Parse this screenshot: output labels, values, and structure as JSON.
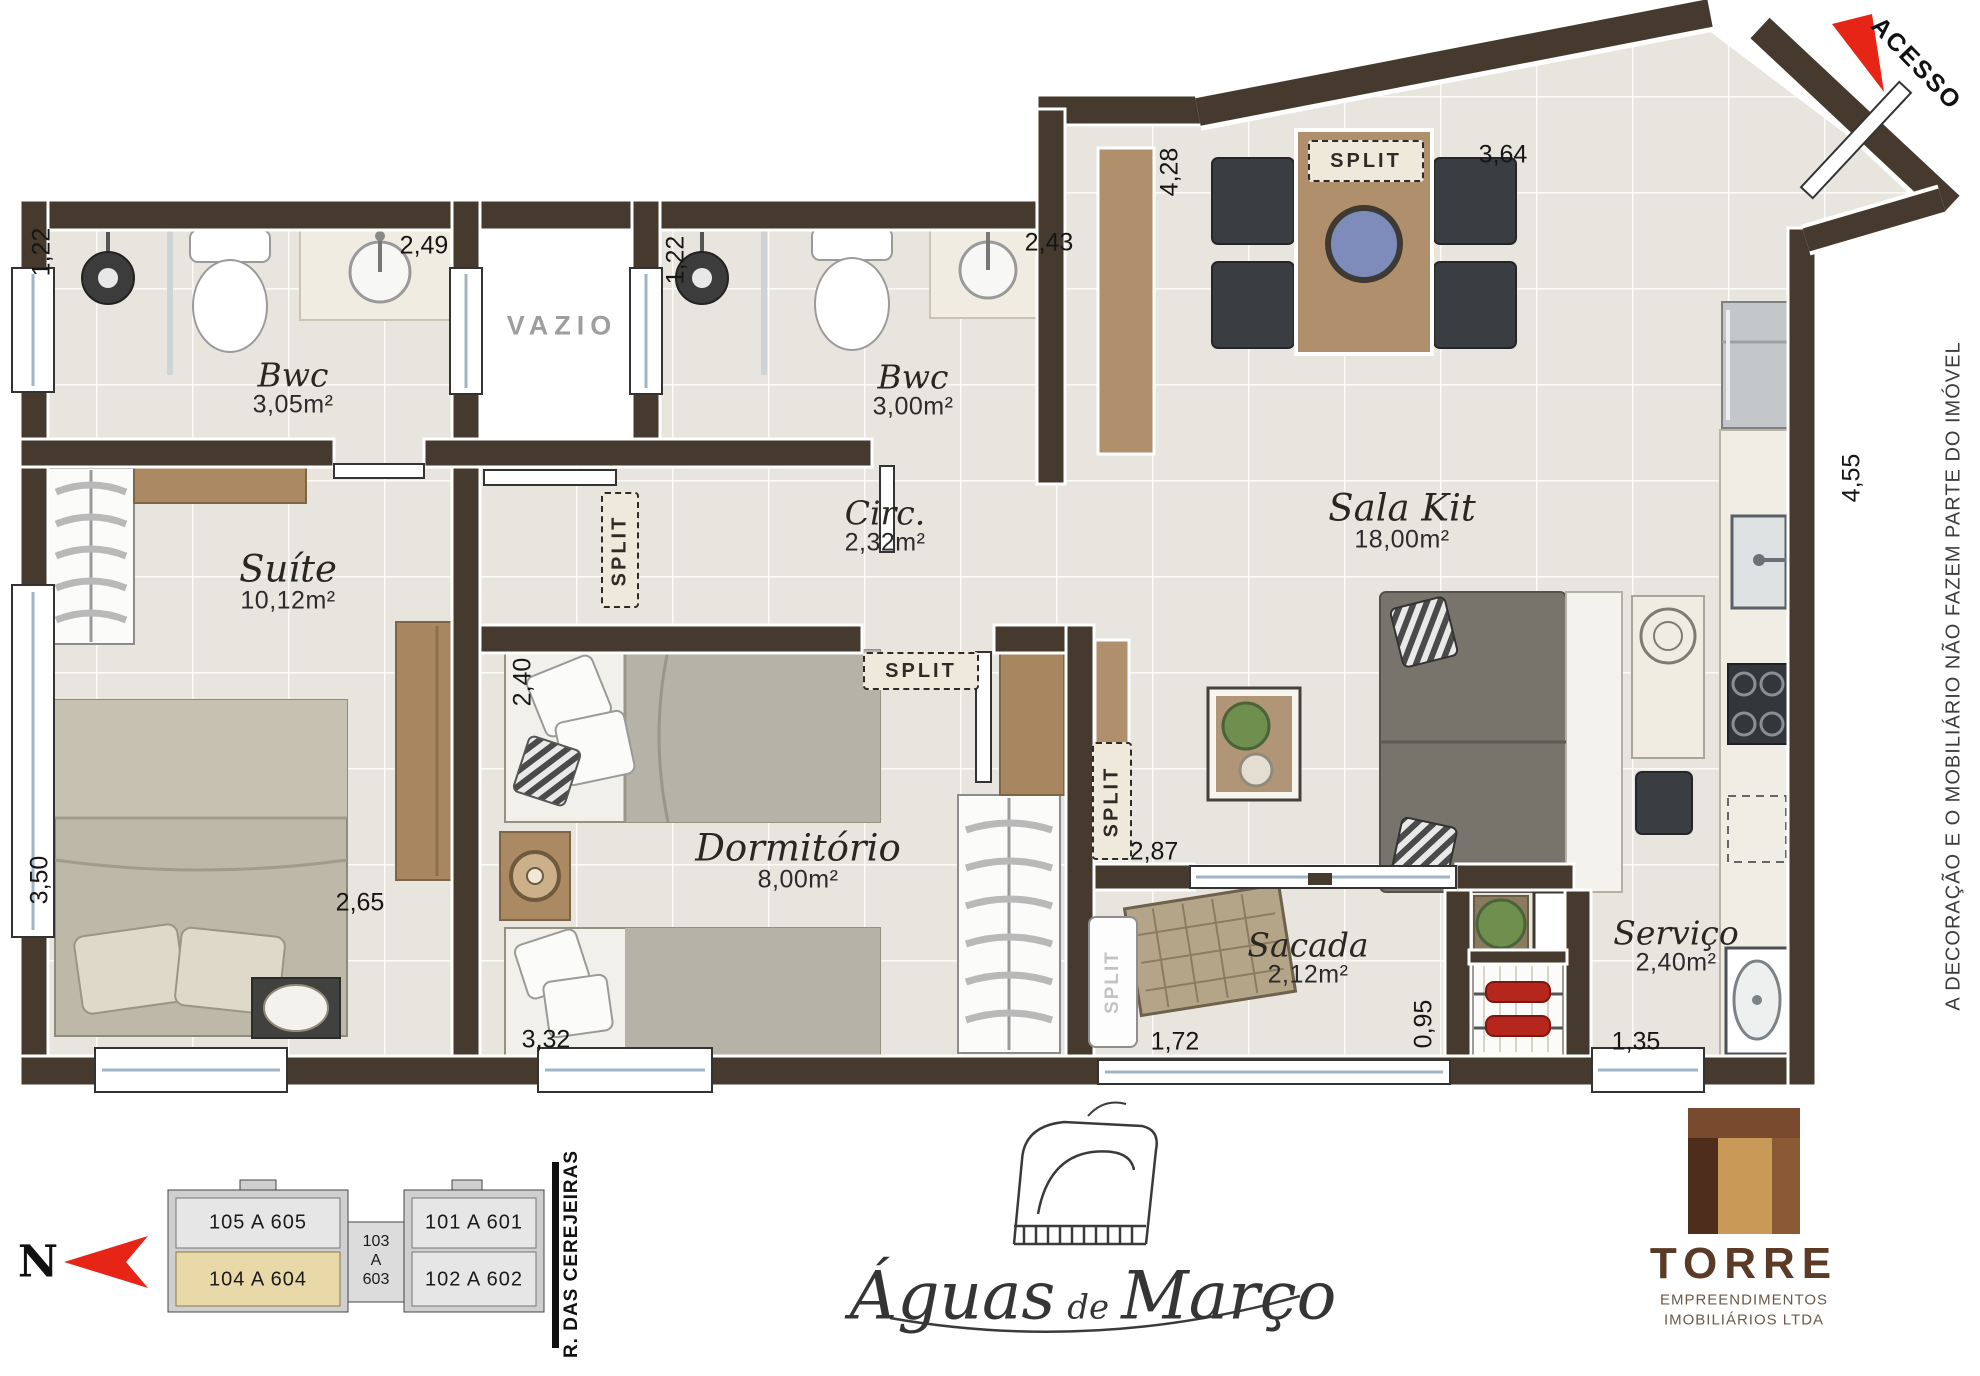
{
  "plan": {
    "rooms": [
      {
        "name": "Bwc",
        "area": "3,05m²"
      },
      {
        "name": "Bwc",
        "area": "3,00m²"
      },
      {
        "name": "Suíte",
        "area": "10,12m²"
      },
      {
        "name": "Circ.",
        "area": "2,32m²"
      },
      {
        "name": "Sala Kit",
        "area": "18,00m²"
      },
      {
        "name": "Dormitório",
        "area": "8,00m²"
      },
      {
        "name": "Sacada",
        "area": "2,12m²"
      },
      {
        "name": "Serviço",
        "area": "2,40m²"
      }
    ],
    "vazio": "VAZIO",
    "acesso": "ACESSO",
    "split": "SPLIT",
    "disclaimer": "A DECORAÇÃO E O MOBILIÁRIO NÃO FAZEM PARTE DO IMÓVEL",
    "dimensions": {
      "bwc1_width": "1,22",
      "bwc1_length": "2,49",
      "bwc2_width": "1,22",
      "bwc2_length": "2,43",
      "sala_depth": "4,28",
      "sala_width": "3,64",
      "kitchen_depth": "4,55",
      "dorm_width": "2,40",
      "dorm_length": "3,32",
      "suite_depth": "3,50",
      "suite_width": "2,65",
      "sala_lower_width": "2,87",
      "sacada_width": "1,72",
      "churrasqueira_width": "0,95",
      "servico_width": "1,35"
    }
  },
  "keyplan": {
    "north": "N",
    "street": "R. DAS CEREJEIRAS",
    "units": {
      "top_left": "105 A 605",
      "top_right": "101 A 601",
      "bottom_left": "104 A 604",
      "bottom_right": "102 A 602",
      "core_1": "103",
      "core_2": "A",
      "core_3": "603"
    }
  },
  "branding": {
    "project": {
      "word1": "Águas",
      "word2": "de",
      "word3": "Março"
    },
    "builder": {
      "name": "TORRE",
      "line1": "EMPREENDIMENTOS",
      "line2": "IMOBILIÁRIOS LTDA"
    }
  }
}
